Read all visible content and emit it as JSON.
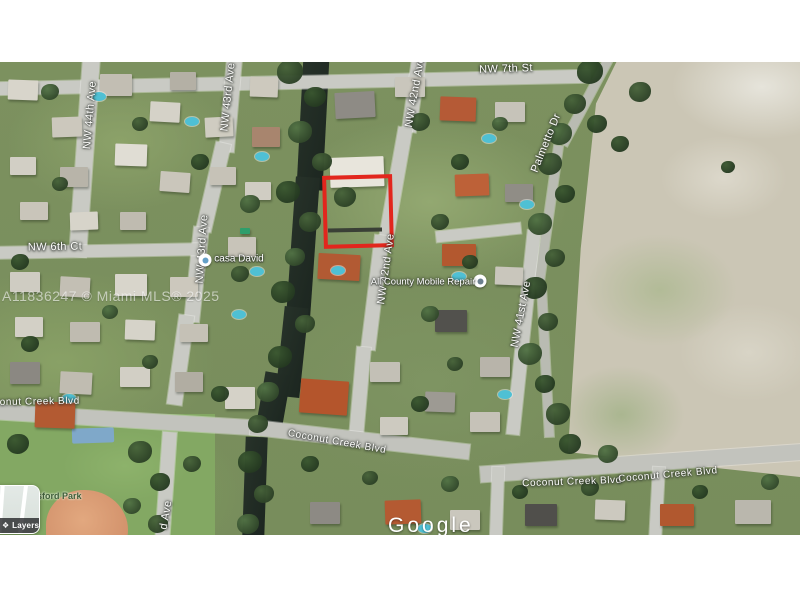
{
  "window": {
    "background": "#ffffff"
  },
  "map": {
    "street_labels": [
      "NW 44th Ave",
      "NW 43rd Ave",
      "NW 42nd Ave",
      "NW 7th St",
      "Palmetto Dr",
      "NW 42nd Ave",
      "NW 41st Ave",
      "NW 6th Ct",
      "NW 43rd Ave",
      "d Ave",
      "Coconut Creek Blvd",
      "Coconut Creek Blvd",
      "Coconut Creek Blvd",
      "Coconut Creek Blvd"
    ],
    "pois": [
      {
        "label": "casa David"
      },
      {
        "label": "All County Mobile Repair"
      }
    ],
    "park_label": "sford Park",
    "watermark": "A11836247 © Miami MLS® 2025",
    "attribution": "Google",
    "layers_label": "Layers",
    "colors": {
      "parcel_outline": "#e2261d",
      "water": "#232e27",
      "road": "#c9cac4",
      "field": "#cbc6b5",
      "park_label_green": "#3f5e3a",
      "pool_blue": "#4fc0d4"
    }
  }
}
